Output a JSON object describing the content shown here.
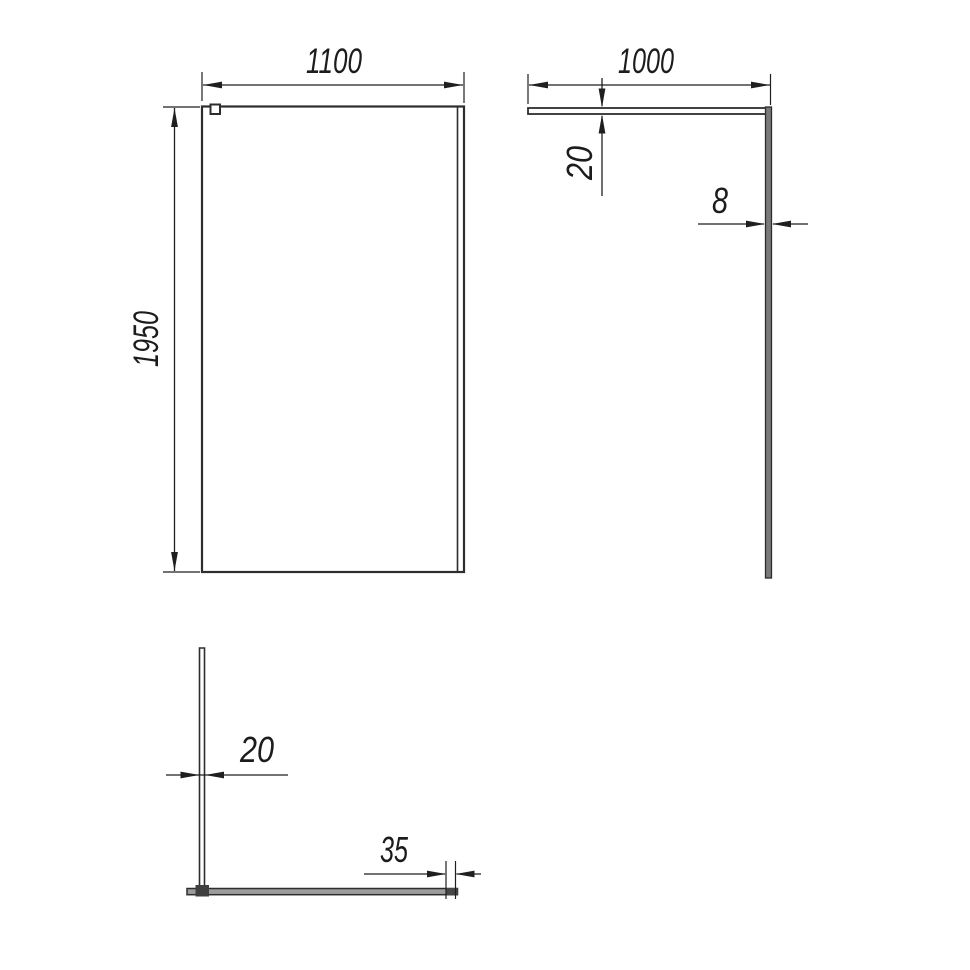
{
  "views": {
    "front": {
      "name": "front view",
      "dims": {
        "width_label": "1100",
        "height_label": "1950"
      }
    },
    "side": {
      "name": "side view",
      "dims": {
        "length_label": "1000",
        "bar_thickness_label": "20",
        "glass_thickness_label": "8"
      }
    },
    "plan": {
      "name": "plan view",
      "dims": {
        "profile_width_label": "20",
        "wall_profile_label": "35"
      }
    }
  },
  "colors": {
    "background": "#ffffff",
    "line": "#2d2d2d",
    "glass_edge_fill": "#7a7a7a",
    "panel_fill": "#9c9c9c",
    "connector_fill": "#3f3f3f",
    "wall_profile_fill": "#474747"
  }
}
